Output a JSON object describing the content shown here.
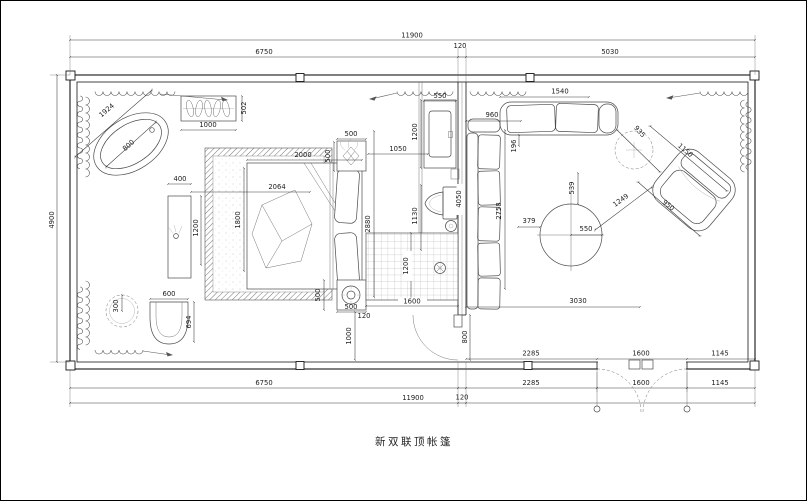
{
  "title": {
    "text": "新双联顶帐篷"
  },
  "dims": {
    "top_total": "11900",
    "top_left": "6750",
    "top_gap": "120",
    "top_right": "5030",
    "left_height": "4900",
    "bottom_r1_a": "2285",
    "bottom_r1_b": "1600",
    "bottom_r1_c": "1145",
    "bottom_r2_left": "6750",
    "bottom_r2_a": "2285",
    "bottom_r2_b": "1600",
    "bottom_r2_c": "1145",
    "bottom_total": "11900",
    "bottom_gap": "120",
    "tub_diagonal": "1924",
    "tub_radius": "800",
    "planter_width": "1000",
    "planter_depth": "502",
    "vanity_width": "400",
    "vanity_length": "1200",
    "tub_to_bed": "2064",
    "stool_radius": "300",
    "chair_width": "600",
    "chair_depth": "694",
    "carpet_side": "1800",
    "bed_width": "2000",
    "nightstand_top_width": "500",
    "nightstand_top_depth": "500",
    "nightstand_bottom_depth": "500",
    "nightstand_bottom_width": "500",
    "bed_zone_depth": "2880",
    "bed_to_wall": "1050",
    "basin_width": "550",
    "basin_depth": "1200",
    "toilet_depth": "1130",
    "shower_width": "1600",
    "shower_depth": "1200",
    "nightstand_gap": "120",
    "nightstand_to_wall": "1000",
    "door_width": "800",
    "partition_length": "4050",
    "sofa_length": "2758",
    "sofa_gap": "196",
    "sofa_offset": "960",
    "sofa_top_width": "1540",
    "table_gap": "539",
    "table_offset": "379",
    "table_radius": "550",
    "table_to_chair": "1249",
    "side_table": "935",
    "armchair_width": "1150",
    "armchair_depth": "950",
    "living_width": "3030"
  }
}
